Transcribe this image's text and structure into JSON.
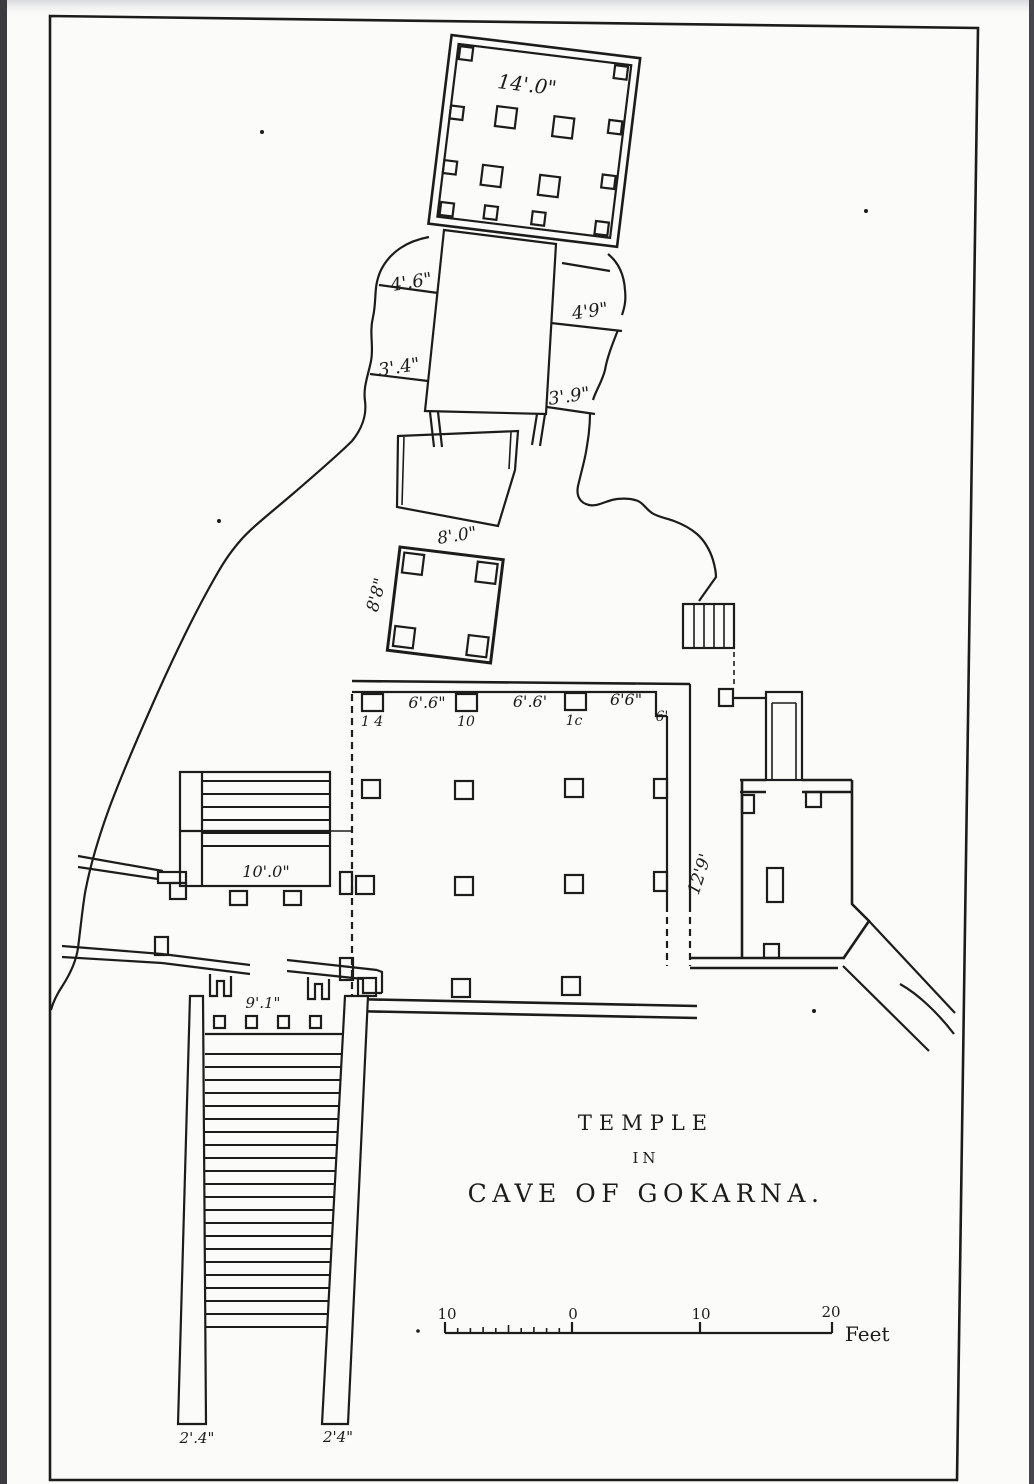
{
  "plate": {
    "title": {
      "line1": "TEMPLE",
      "line2": "IN",
      "line3": "CAVE OF GOKARNA."
    },
    "labels": {
      "top_hall_width": "14'.0\"",
      "stair_upper_left": "4'.6\"",
      "stair_upper_right": "4'9\"",
      "stair_lower_left": "3'.4\"",
      "stair_lower_right": "3'.9\"",
      "pavilion_width": "8'.0\"",
      "pavilion_depth": "8'8\"",
      "bay1": "6'.6\"",
      "bay2": "6'.6'",
      "bay3": "6'6\"",
      "pier1": "1 4",
      "pier2": "10",
      "pier3": "1c",
      "pier4": "6'",
      "west_stair": "10'.0\"",
      "entrance_width": "9'.1\"",
      "east_room": "12'9'",
      "passage_left": "2'.4\"",
      "passage_right": "2'4\""
    },
    "scale_bar": {
      "tick_labels": [
        "10",
        "0",
        "10",
        "20"
      ],
      "unit": "Feet"
    },
    "colors": {
      "ink": "#1c1c1c",
      "paper": "#fbfbfa",
      "scan_edge": "#3b3b41"
    }
  }
}
